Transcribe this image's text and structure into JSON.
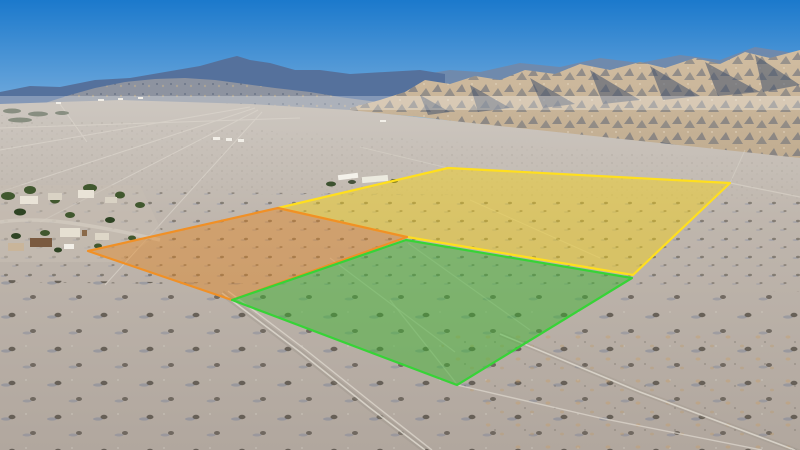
{
  "scene": {
    "kind": "aerial-drone-photo",
    "subject": "desert land parcels outlined for sale with mountains behind",
    "parcel_count": 3
  },
  "colors": {
    "sky_top": "#1b79cc",
    "sky_mid": "#6fa9dc",
    "sky_horizon": "#cfe7f3",
    "far_ridge_right": "#7189ab",
    "far_range_left": "#55719c",
    "foothills": "#8d93a0",
    "badlands_light": "#d1bda1",
    "badlands_dark": "#c0ac90",
    "badlands_shadow": "#44536d",
    "plain_far": "#cdc7c0",
    "plain_mid": "#bfb6ad",
    "plain_near": "#b1a79e",
    "road_light": "#dcd6cc",
    "road_halo": "#968e84",
    "tree_green": "#41582f",
    "parcel_yellow_fill": "rgba(255,216,0,0.40)",
    "parcel_yellow_line": "#ffdf1e",
    "parcel_orange_fill": "rgba(235,125,10,0.38)",
    "parcel_orange_line": "#f09026",
    "parcel_green_fill": "rgba(58,180,45,0.48)",
    "parcel_green_line": "#37d337"
  },
  "parcels": {
    "north": {
      "label": "yellow-outlined parcel",
      "points": "278,208 448,168 730,183 633,275 407,237"
    },
    "west": {
      "label": "orange-outlined parcel",
      "points": "88,251 278,208 407,237 232,300"
    },
    "south": {
      "label": "green-outlined parcel",
      "points": "406,240 632,278 457,385 232,300"
    }
  },
  "roads": {
    "main_track": "222,293 300,352 370,408 425,450",
    "main_track_b": "228,291 306,350 376,406 432,450",
    "east_track": "500,334 640,392 800,452",
    "south_track": "457,385 600,418 762,450",
    "green_inner_1": "330,258 455,352",
    "green_inner_2": "408,243 530,330",
    "yellow_inner": "470,200 600,258",
    "ne_boundary_road": "730,183 800,197",
    "ne_up_road": "730,183 745,150",
    "nw_road": "448,168 360,147"
  }
}
